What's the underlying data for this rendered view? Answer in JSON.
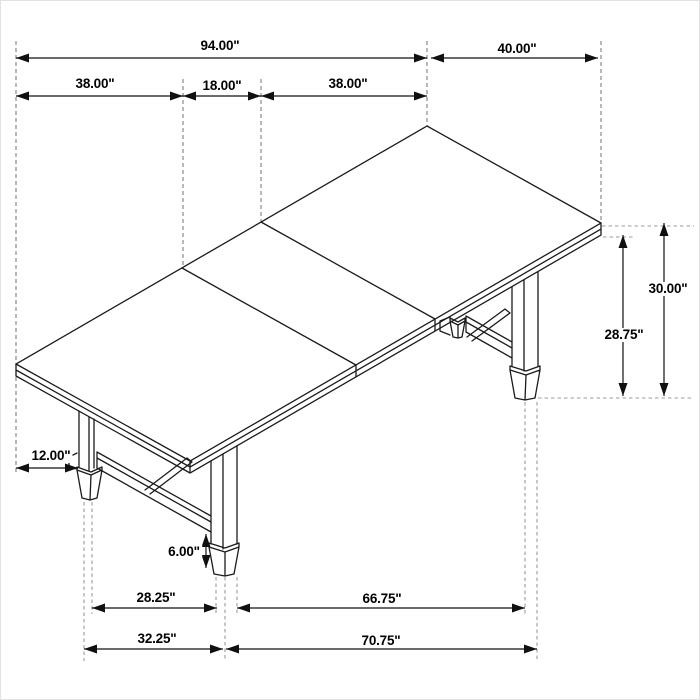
{
  "diagram": {
    "title": "Dining table dimension drawing",
    "subject": "trestle dining table, isometric line drawing with dimension callouts",
    "units": "inches",
    "style": {
      "background": "#ffffff",
      "line_color": "#1b1b1b",
      "extension_line_color": "#7d7d7d",
      "projection_line_color": "#9b9b9b",
      "text_color": "#000000"
    },
    "dimensions": {
      "length_total": {
        "value": 94.0,
        "label": "94.00\"",
        "orientation": "horizontal"
      },
      "width_total": {
        "value": 40.0,
        "label": "40.00\"",
        "orientation": "horizontal"
      },
      "segment_left": {
        "value": 38.0,
        "label": "38.00\"",
        "orientation": "horizontal"
      },
      "segment_center": {
        "value": 18.0,
        "label": "18.00\"",
        "orientation": "horizontal"
      },
      "segment_right": {
        "value": 38.0,
        "label": "38.00\"",
        "orientation": "horizontal"
      },
      "height_total": {
        "value": 30.0,
        "label": "30.00\"",
        "orientation": "vertical"
      },
      "height_to_underside": {
        "value": 28.75,
        "label": "28.75\"",
        "orientation": "vertical"
      },
      "end_overhang": {
        "value": 12.0,
        "label": "12.00\"",
        "orientation": "horizontal"
      },
      "foot_height": {
        "value": 6.0,
        "label": "6.00\"",
        "orientation": "vertical"
      },
      "feet_inner_left": {
        "value": 28.25,
        "label": "28.25\"",
        "orientation": "horizontal"
      },
      "feet_inner_right": {
        "value": 66.75,
        "label": "66.75\"",
        "orientation": "horizontal"
      },
      "feet_outer_left": {
        "value": 32.25,
        "label": "32.25\"",
        "orientation": "horizontal"
      },
      "feet_outer_right": {
        "value": 70.75,
        "label": "70.75\"",
        "orientation": "horizontal"
      }
    }
  }
}
